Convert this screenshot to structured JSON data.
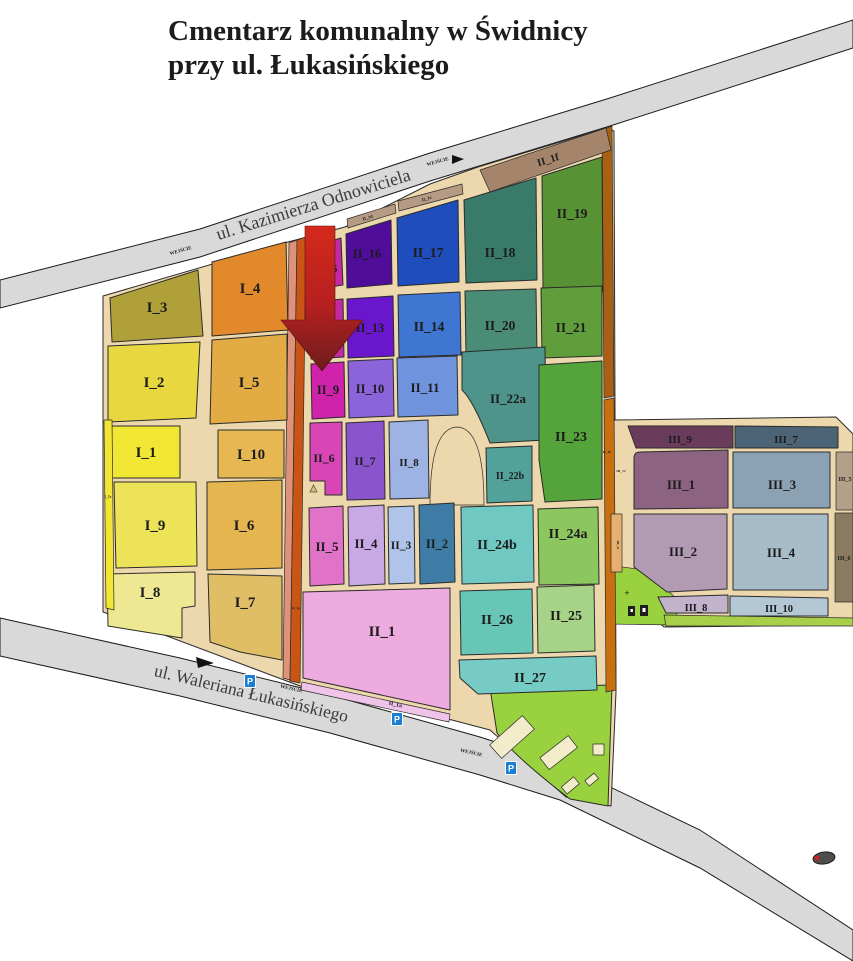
{
  "title": {
    "line1": "Cmentarz komunalny w Świdnicy",
    "line2": "przy ul. Łukasińskiego"
  },
  "streets": {
    "top": "ul. Kazimierza Odnowiciela",
    "bottom": "ul. Waleriana Łukasińskiego"
  },
  "labels": {
    "entrance": "WEJŚCIE",
    "parking": "P",
    "plus_marker": "+"
  },
  "sections_I": {
    "I_1": {
      "label": "I_1",
      "color": "#f2e635"
    },
    "I_2": {
      "label": "I_2",
      "color": "#e9d73f"
    },
    "I_3": {
      "label": "I_3",
      "color": "#b0a03a"
    },
    "I_4": {
      "label": "I_4",
      "color": "#e2892b"
    },
    "I_5": {
      "label": "I_5",
      "color": "#e2ab43"
    },
    "I_6": {
      "label": "I_6",
      "color": "#e5b54f"
    },
    "I_7": {
      "label": "I_7",
      "color": "#e0be66"
    },
    "I_8": {
      "label": "I_8",
      "color": "#eee893"
    },
    "I_9": {
      "label": "I_9",
      "color": "#ece358"
    },
    "I_10": {
      "label": "I_10",
      "color": "#e7b852"
    },
    "I_1c": {
      "label": "I_1c",
      "color": "#f2e635"
    }
  },
  "sections_II": {
    "II_1": {
      "label": "II_1",
      "color": "#eeabdf"
    },
    "II_1a": {
      "label": "II_1a",
      "color": "#f0c3e8"
    },
    "II_1b": {
      "label": "II_1b"
    },
    "II_1d": {
      "label": "II_1d",
      "color": "#b59a84"
    },
    "II_1e": {
      "label": "II_1e",
      "color": "#b59a84"
    },
    "II_1f": {
      "label": "II_1f",
      "color": "#a5846c"
    },
    "II_1g": {
      "label": "II_1g"
    },
    "II_2": {
      "label": "II_2",
      "color": "#3e7ca6"
    },
    "II_3": {
      "label": "II_3",
      "color": "#b0c4ea"
    },
    "II_4": {
      "label": "II_4",
      "color": "#c9a8e6"
    },
    "II_5": {
      "label": "II_5",
      "color": "#e072c8"
    },
    "II_6": {
      "label": "II_6",
      "color": "#d846b5"
    },
    "II_7": {
      "label": "II_7",
      "color": "#8a55cc"
    },
    "II_8": {
      "label": "II_8",
      "color": "#9db3e4"
    },
    "II_9": {
      "label": "II_9",
      "color": "#d023ab"
    },
    "II_10": {
      "label": "II_10",
      "color": "#8a64d8"
    },
    "II_11": {
      "label": "II_11",
      "color": "#6f93dd"
    },
    "II_12": {
      "label": "II_12",
      "color": "#c32aa2"
    },
    "II_13": {
      "label": "II_13",
      "color": "#6a16cc"
    },
    "II_14": {
      "label": "II_14",
      "color": "#3e76d2"
    },
    "II_15": {
      "label": "II_15",
      "color": "#c32aa2"
    },
    "II_16": {
      "label": "II_16",
      "color": "#4f0d99"
    },
    "II_17": {
      "label": "II_17",
      "color": "#1f4dbb"
    },
    "II_18": {
      "label": "II_18",
      "color": "#3a7a68"
    },
    "II_19": {
      "label": "II_19",
      "color": "#579334"
    },
    "II_20": {
      "label": "II_20",
      "color": "#4a8c76"
    },
    "II_21": {
      "label": "II_21",
      "color": "#5f9e3a"
    },
    "II_22a": {
      "label": "II_22a",
      "color": "#4e948a"
    },
    "II_22b": {
      "label": "II_22b",
      "color": "#52a29b"
    },
    "II_23": {
      "label": "II_23",
      "color": "#55a43b"
    },
    "II_24a": {
      "label": "II_24a",
      "color": "#8cc65f"
    },
    "II_24b": {
      "label": "II_24b",
      "color": "#6fc8c1"
    },
    "II_25": {
      "label": "II_25",
      "color": "#a6d388"
    },
    "II_26": {
      "label": "II_26",
      "color": "#68c6b6"
    },
    "II_27": {
      "label": "II_27",
      "color": "#77cbc5"
    }
  },
  "sections_III": {
    "III_1": {
      "label": "III_1",
      "color": "#8c6380"
    },
    "III_2": {
      "label": "III_2",
      "color": "#b29ab3"
    },
    "III_3": {
      "label": "III_3",
      "color": "#8ba2b5"
    },
    "III_4": {
      "label": "III_4",
      "color": "#a7bbc8"
    },
    "III_5": {
      "label": "III_5",
      "color": "#b2a088"
    },
    "III_6": {
      "label": "III_6",
      "color": "#8a7a60"
    },
    "III_7": {
      "label": "III_7",
      "color": "#4d6477"
    },
    "III_8": {
      "label": "III_8",
      "color": "#c2b2cc"
    },
    "III_9": {
      "label": "III_9",
      "color": "#6a3c5c"
    },
    "III_10": {
      "label": "III_10",
      "color": "#b4c7d4"
    },
    "III_11": {
      "label": "III_11",
      "color": "#e8b070"
    },
    "III_12": {
      "label": "III_12"
    }
  },
  "palette": {
    "ground": "#ecd8ac",
    "road": "#d9d9d9",
    "road_border": "#1a1a1a",
    "lawn": "#9ad23f",
    "lawn_strip": "#a8cf4a",
    "building": "#f2ecca",
    "strip_salmon": "#df9179",
    "strip_orange": "#c85515",
    "border_strip_top": "#a86114",
    "border_strip_bottom": "#c87010",
    "parking_blue": "#1a7fd4",
    "arrow_top": "#d4291b",
    "arrow_mid": "#b52020",
    "arrow_bottom": "#6e1c1c",
    "marker_gray": "#4d4d4d",
    "marker_red": "#cc2222"
  }
}
